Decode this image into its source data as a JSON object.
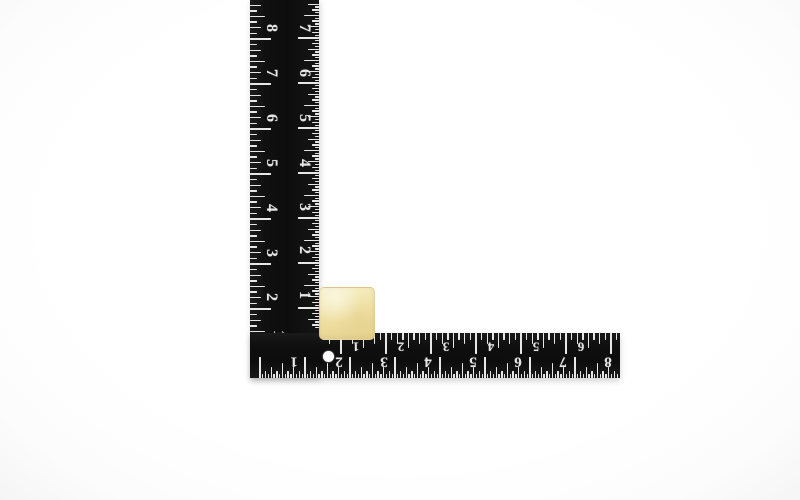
{
  "scene": {
    "background_color": "#ffffff",
    "object_names": [
      "framing-square-ruler",
      "sponge-cube"
    ]
  },
  "square_ruler": {
    "body_color": "#131313",
    "mark_color": "#e8e8e8",
    "unit_label": "INCH",
    "vertical_arm": {
      "outer_scale": {
        "numbers": [
          "8",
          "7",
          "6",
          "5",
          "4",
          "3",
          "2",
          "1"
        ]
      },
      "inner_scale": {
        "numbers": [
          "7",
          "6",
          "5",
          "4",
          "3",
          "2",
          "1"
        ]
      }
    },
    "horizontal_arm": {
      "inner_scale": {
        "numbers": [
          "1",
          "2",
          "3",
          "4",
          "5",
          "6"
        ]
      },
      "outer_scale": {
        "numbers": [
          "1",
          "2",
          "3",
          "4",
          "5",
          "6",
          "7",
          "8"
        ]
      }
    },
    "hanging_hole_color": "#fdfdfd"
  },
  "cube": {
    "color": "#f1e3a7",
    "highlight_color": "#f8f1cd",
    "shadow_color": "#e6d28e"
  }
}
